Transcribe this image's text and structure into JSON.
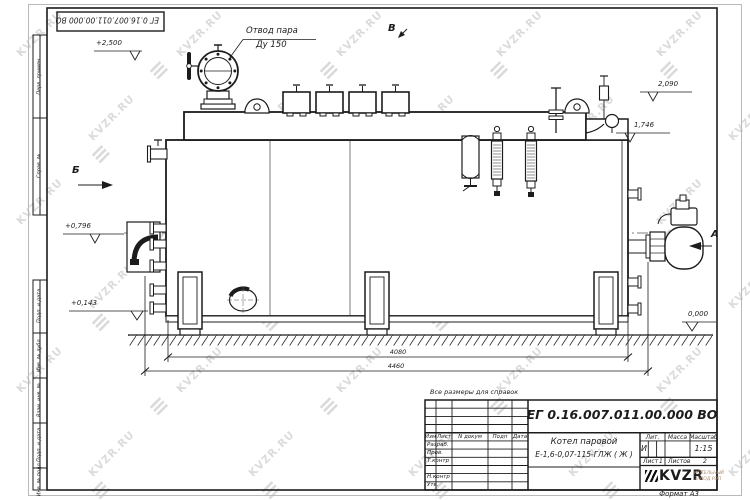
{
  "sheet": {
    "format_label": "Формат А3",
    "top_designation": "ЕГ 0.16.007.011.00.000  ВО",
    "note": "Все размеры для справок"
  },
  "frame_left_fields": [
    {
      "label": "Перв. примен."
    },
    {
      "label": "Справ. №"
    },
    {
      "label": "Подп. и дата"
    },
    {
      "label": "Инв. № дубл."
    },
    {
      "label": "Взам. инв. №"
    },
    {
      "label": "Подп. и дата"
    },
    {
      "label": "Инв. № подл."
    }
  ],
  "title_block": {
    "designation": "ЕГ 0.16.007.011.00.000  ВО",
    "name_line1": "Котел паровой",
    "name_line2": "Е-1,6-0,07-115-ГЛЖ ( Ж )",
    "header_cells": [
      "Изм",
      "Лист",
      "N докум",
      "Подп",
      "Дата"
    ],
    "rows": [
      "Разраб.",
      "Пров.",
      "Т.контр",
      "",
      "Н.контр",
      "Утв."
    ],
    "lit_header": "Лит.",
    "mass_header": "Масса",
    "scale_header": "Масштаб",
    "lit_value": "И",
    "scale_value": "1:15",
    "sheet_label": "Лист",
    "sheet_value": "1",
    "sheets_label": "Листов",
    "sheets_value": "2",
    "logo_text": "KVZR",
    "logo_sub1": "КОТЕЛЬНЫЙ",
    "logo_sub2": "ЗАВОД РЭП"
  },
  "annotations": {
    "steam_outlet_line1": "Отвод пара",
    "steam_outlet_line2": "Ду 150",
    "view_b_top": "В",
    "view_b_left": "Б",
    "view_a_right": "А"
  },
  "levels": [
    {
      "text": "+2,500"
    },
    {
      "text": "2,090"
    },
    {
      "text": "1,746"
    },
    {
      "text": "+0,796"
    },
    {
      "text": "+0,143"
    },
    {
      "text": "0,000"
    }
  ],
  "dimensions": [
    {
      "text": "4080"
    },
    {
      "text": "4460"
    }
  ],
  "watermark": {
    "text": "KVZR.RU"
  },
  "colors": {
    "line": "#1c1c1c",
    "watermark": "#c6c6c6",
    "logo_tan": "#ab9078"
  }
}
